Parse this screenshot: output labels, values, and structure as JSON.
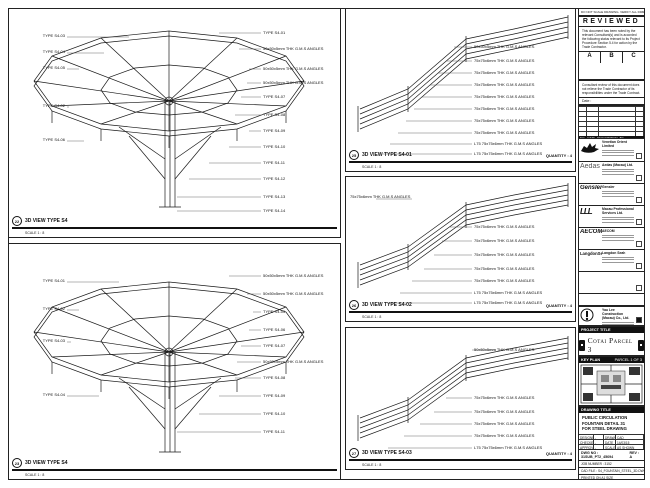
{
  "note_strip": {
    "text": "DO NOT SCALE DRAWING. VERIFY ALL DIMENSIONS ON SITE."
  },
  "stamp": {
    "title": "REVIEWED",
    "body": "This document has been noted by the relevant Consultant(s) and is accorded the following status relevant to its Project Procedure Section 5.4 for action by the Trade Contractor.",
    "options": [
      "A",
      "B",
      "C"
    ],
    "disclaimer": "Consultant review of this document does not relieve the Trade Contractor of its responsibilities under the Trade Contract.",
    "date_label": "Date :"
  },
  "revisions": {
    "headers": [
      "NO.",
      "DATE",
      "DESCRIPTION",
      "BY"
    ]
  },
  "consultants": {
    "venetian": {
      "name": "Venetian Orient Limited"
    },
    "aedas": {
      "logo": "Aedas",
      "name": "Aedas (Macau) Ltd."
    },
    "gensler": {
      "logo": "Gensler",
      "name": "Gensler"
    },
    "mps": {
      "logo": "LLL",
      "name": "Macau Professional Services Ltd."
    },
    "aecom": {
      "logo": "AECOM",
      "name": "AECOM"
    },
    "langdon": {
      "logo": "LangdonSeah",
      "name": "Langdon Seah"
    }
  },
  "contractor": {
    "name": "Yau Lee Construction (Macau) Co., Ltd."
  },
  "project": {
    "band": "PROJECT TITLE",
    "name": "Cotai Parcel 3"
  },
  "key_plan": {
    "band": "KEY PLAN",
    "note": "PARCEL 1 OF 3"
  },
  "title_block": {
    "band": "DRAWING TITLE",
    "lines": [
      "PUBLIC CIRCULATION",
      "FOUNTAIN DETAIL 31",
      "FOR STEEL DRAWING"
    ],
    "rows": [
      {
        "l1": "DESIGNED",
        "v1": "-",
        "l2": "DRAWN",
        "v2": "CAD"
      },
      {
        "l1": "CHECKED",
        "v1": "-",
        "l2": "DATE",
        "v2": "14/03/15"
      },
      {
        "l1": "APPROVED",
        "v1": "-",
        "l2": "SCALE",
        "v2": "AS SHOWN"
      }
    ],
    "dwg_label": "DWG NO :",
    "dwg_no": "31SUB_PT2_45694",
    "rev_label": "REV :",
    "rev": "A",
    "job": "JOB NUMBER : 3152",
    "file": "CAD FILE : S4_FOUNTAIN_STEEL_3D.DWG",
    "sheet": "PRINTED ON A1 SIZE"
  },
  "panels": {
    "tl": {
      "ref": "22",
      "title": "3D VIEW TYPE S4",
      "scale": "SCALE 1 : 8",
      "left": [
        "TYPE S4-03",
        "TYPE S4-04",
        "TYPE S4-05",
        "TYPE S4-02",
        "TYPE S4-06"
      ],
      "right": [
        "TYPE S4-01",
        "50x50x5mm THK G.M.S ANGLES",
        "50x50x5mm THK G.M.S ANGLES",
        "50x50x5mm THK G.M.S ANGLES",
        "TYPE S4-07",
        "TYPE S4-08",
        "TYPE S4-09",
        "TYPE S4-10",
        "TYPE S4-11",
        "TYPE S4-12"
      ],
      "bottom": [
        "TYPE S4-13",
        "TYPE S4-14"
      ]
    },
    "bl": {
      "ref": "23",
      "title": "3D VIEW TYPE S4",
      "scale": "SCALE 1 : 8",
      "left": [
        "TYPE S4-01",
        "TYPE S4-02",
        "TYPE S4-03",
        "TYPE S4-04"
      ],
      "right": [
        "50x50x5mm THK G.M.S ANGLES",
        "50x50x5mm THK G.M.S ANGLES",
        "TYPE S4-05",
        "TYPE S4-06",
        "TYPE S4-07",
        "50x50x5mm THK G.M.S ANGLES",
        "TYPE S4-08",
        "TYPE S4-09",
        "TYPE S4-10",
        "TYPE S4-11"
      ]
    },
    "m1": {
      "ref": "25",
      "title": "3D VIEW TYPE S4-01",
      "scale": "SCALE 1 : 8",
      "qty": "QUANTITY : 4",
      "right": [
        "50x50x5mm THK G.M.S ANGLES",
        "75x75x6mm THK G.M.S ANGLES",
        "75x75x6mm THK G.M.S ANGLES",
        "75x75x6mm THK G.M.S ANGLES",
        "75x75x6mm THK G.M.S ANGLES",
        "75x75x6mm THK G.M.S ANGLES",
        "75x75x6mm THK G.M.S ANGLES",
        "75x75x6mm THK G.M.S ANGLES",
        "L75 75x75x6mm THK G.M.S ANGLES",
        "L75 75x75x6mm THK G.M.S ANGLES"
      ]
    },
    "m2": {
      "ref": "26",
      "title": "3D VIEW TYPE S4-02",
      "scale": "SCALE 1 : 8",
      "qty": "QUANTITY : 4",
      "left0": "75x75x6mm THK G.M.S ANGLES",
      "right": [
        "75x75x6mm THK G.M.S ANGLES",
        "75x75x6mm THK G.M.S ANGLES",
        "75x75x6mm THK G.M.S ANGLES",
        "75x75x6mm THK G.M.S ANGLES",
        "75x75x6mm THK G.M.S ANGLES",
        "L75 75x75x6mm THK G.M.S ANGLES",
        "L75 75x75x6mm THK G.M.S ANGLES"
      ]
    },
    "m3": {
      "ref": "27",
      "title": "3D VIEW TYPE S4-03",
      "scale": "SCALE 1 : 8",
      "qty": "QUANTITY : 4",
      "right": [
        "50x50x5mm THK G.M.S ANGLES",
        "75x75x6mm THK G.M.S ANGLES",
        "75x75x6mm THK G.M.S ANGLES",
        "75x75x6mm THK G.M.S ANGLES",
        "75x75x6mm THK G.M.S ANGLES",
        "L75 75x75x6mm THK G.M.S ANGLES"
      ]
    }
  }
}
